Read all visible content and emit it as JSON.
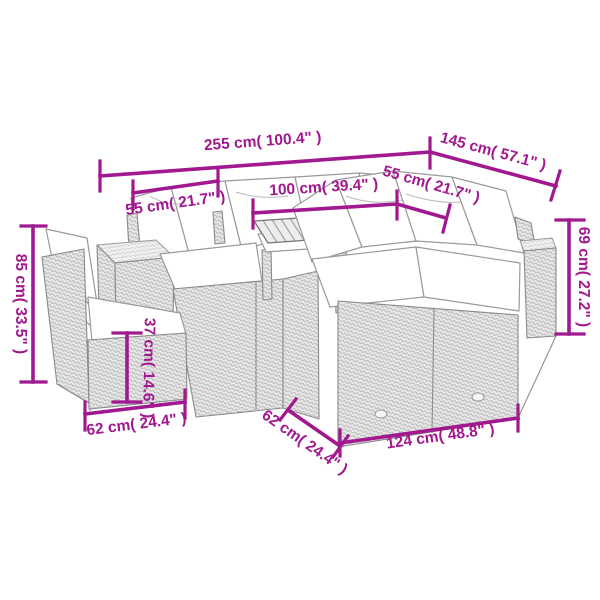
{
  "colors": {
    "accent": "#A1188F",
    "sketch_outline": "#8f8f8f",
    "background": "#ffffff"
  },
  "diagram": {
    "type": "product-dimension-diagram",
    "subject": "rattan garden sofa set with table and ottoman"
  },
  "dims": {
    "overall_width": {
      "cm": 255,
      "inch": 100.4,
      "label": "255 cm( 100.4\" )"
    },
    "overall_depth": {
      "cm": 145,
      "inch": 57.1,
      "label": "145 cm( 57.1\" )"
    },
    "seat_left": {
      "cm": 55,
      "inch": 21.7,
      "label": "55 cm( 21.7\" )"
    },
    "table_width": {
      "cm": 100,
      "inch": 39.4,
      "label": "100 cm( 39.4\" )"
    },
    "seat_right": {
      "cm": 55,
      "inch": 21.7,
      "label": "55 cm( 21.7\" )"
    },
    "back_height": {
      "cm": 85,
      "inch": 33.5,
      "label": "85 cm( 33.5\" )"
    },
    "sofa_height": {
      "cm": 69,
      "inch": 27.2,
      "label": "69 cm( 27.2\" )"
    },
    "ottoman_height": {
      "cm": 37,
      "inch": 14.6,
      "label": "37 cm( 14.6\" )"
    },
    "ottoman_width": {
      "cm": 62,
      "inch": 24.4,
      "label": "62 cm( 24.4\" )"
    },
    "sofa_depth": {
      "cm": 62,
      "inch": 24.4,
      "label": "62 cm( 24.4\" )"
    },
    "sofa_width": {
      "cm": 124,
      "inch": 48.8,
      "label": "124 cm( 48.8\" )"
    }
  }
}
